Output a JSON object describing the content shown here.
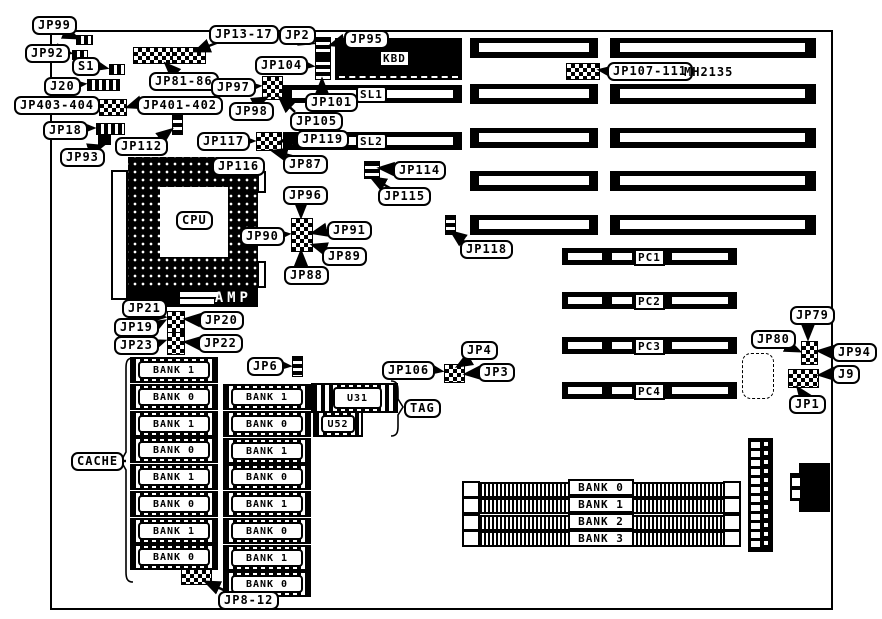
{
  "labels": {
    "jp99": "JP99",
    "jp92": "JP92",
    "s1": "S1",
    "j20": "J20",
    "jp403_404": "JP403-404",
    "jp401_402": "JP401-402",
    "jp18": "JP18",
    "jp93": "JP93",
    "jp112": "JP112",
    "jp13_17": "JP13-17",
    "jp81_86": "JP81-86",
    "jp2": "JP2",
    "jp95": "JP95",
    "kbd": "KBD",
    "jp104": "JP104",
    "jp97": "JP97",
    "jp98": "JP98",
    "jp101": "JP101",
    "jp105": "JP105",
    "sl1": "SL1",
    "sl2": "SL2",
    "jp107_111": "JP107-111",
    "mh2135": "MH2135",
    "jp117": "JP117",
    "jp119": "JP119",
    "jp87": "JP87",
    "jp116": "JP116",
    "cpu": "CPU",
    "amp": "AMP",
    "jp114": "JP114",
    "jp115": "JP115",
    "jp118": "JP118",
    "jp96": "JP96",
    "jp90": "JP90",
    "jp91": "JP91",
    "jp89": "JP89",
    "jp88": "JP88",
    "jp21": "JP21",
    "jp19": "JP19",
    "jp20": "JP20",
    "jp23": "JP23",
    "jp22": "JP22",
    "jp6": "JP6",
    "jp106": "JP106",
    "jp4": "JP4",
    "jp3": "JP3",
    "u31": "U31",
    "u52": "U52",
    "tag": "TAG",
    "cache": "CACHE",
    "jp8_12": "JP8-12",
    "pc1": "PC1",
    "pc2": "PC2",
    "pc3": "PC3",
    "pc4": "PC4",
    "jp79": "JP79",
    "jp80": "JP80",
    "jp94": "JP94",
    "j9": "J9",
    "jp1": "JP1"
  },
  "cache_left": [
    "BANK 1",
    "BANK 0",
    "BANK 1",
    "BANK 0",
    "BANK 1",
    "BANK 0",
    "BANK 1",
    "BANK 0"
  ],
  "cache_middle": [
    "BANK 1",
    "BANK 0",
    "BANK 1",
    "BANK 0",
    "BANK 1",
    "BANK 0",
    "BANK 1",
    "BANK 0"
  ],
  "simm_banks": [
    "BANK 0",
    "BANK 1",
    "BANK 2",
    "BANK 3"
  ],
  "colors": {
    "ink": "#000000",
    "paper": "#ffffff"
  }
}
